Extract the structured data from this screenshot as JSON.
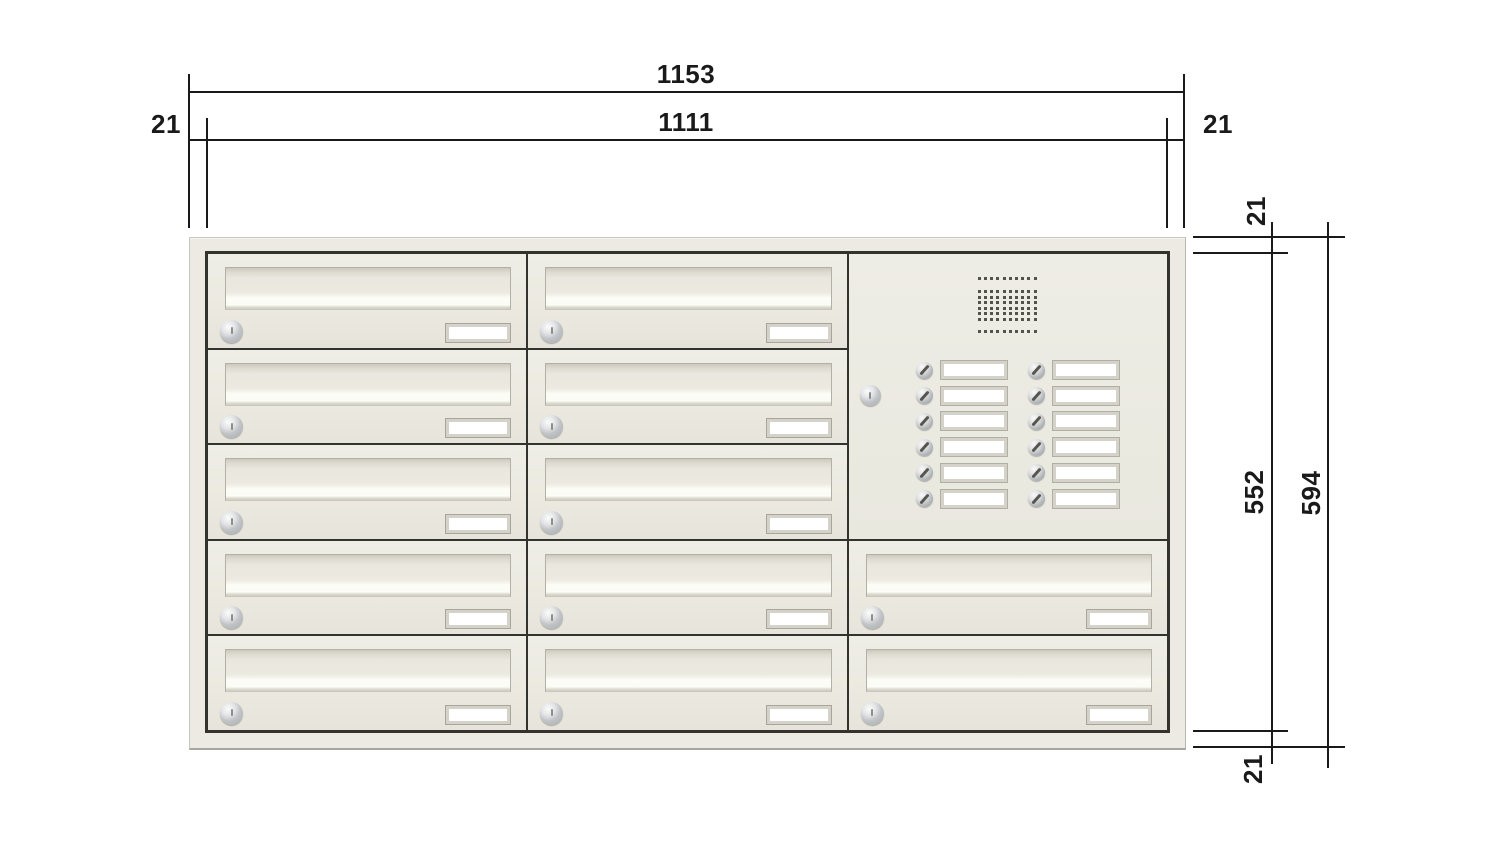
{
  "dimensions": {
    "overall_width": "1153",
    "inner_width": "1111",
    "left_margin": "21",
    "right_margin": "21",
    "top_margin": "21",
    "inner_height": "552",
    "overall_height": "594",
    "bottom_margin": "21"
  },
  "cabinet": {
    "columns": 3,
    "rows": 5,
    "mailbox_count": 12,
    "mailboxes": [
      {
        "col": 0,
        "row": 0
      },
      {
        "col": 1,
        "row": 0
      },
      {
        "col": 0,
        "row": 1
      },
      {
        "col": 1,
        "row": 1
      },
      {
        "col": 0,
        "row": 2
      },
      {
        "col": 1,
        "row": 2
      },
      {
        "col": 0,
        "row": 3
      },
      {
        "col": 1,
        "row": 3
      },
      {
        "col": 2,
        "row": 3
      },
      {
        "col": 0,
        "row": 4
      },
      {
        "col": 1,
        "row": 4
      },
      {
        "col": 2,
        "row": 4
      }
    ],
    "intercom": {
      "col": 2,
      "row": 0,
      "row_span": 3,
      "bell_count": 12,
      "bell_rows": 6,
      "bell_columns": 2,
      "has_speaker": true,
      "has_lock": true
    },
    "speaker_grille": {
      "columns": 10,
      "rows": 8
    }
  },
  "colors": {
    "page_bg": "#ffffff",
    "panel_face": "#eceae2",
    "cell_face": "#ebe9e0",
    "divider": "#33322d",
    "flap_highlight": "#fdfdf8",
    "plate_frame": "#d5d3c9",
    "metal": "#b4b7ba",
    "dimension_line": "#1a1a1a"
  }
}
